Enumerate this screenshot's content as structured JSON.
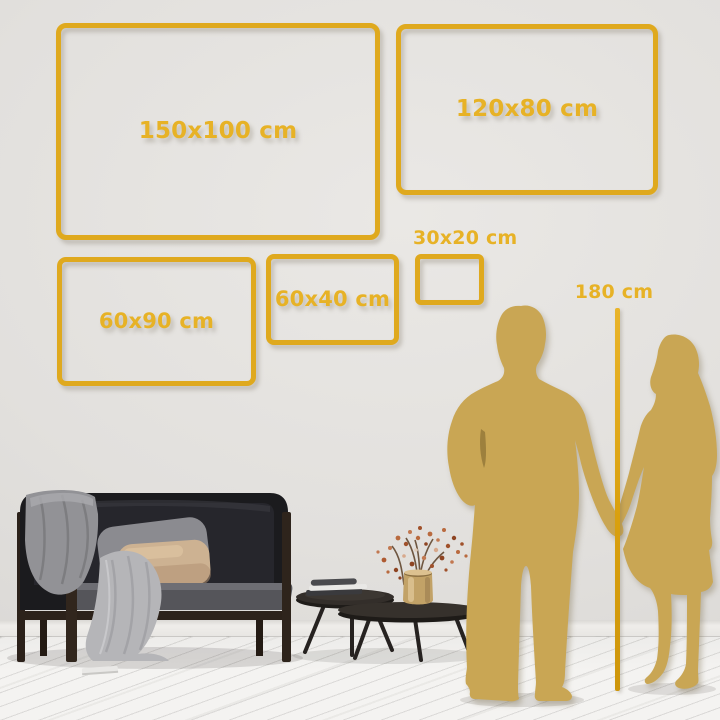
{
  "size_frames": [
    {
      "id": "150x100",
      "label": "150x100 cm"
    },
    {
      "id": "120x80",
      "label": "120x80 cm"
    },
    {
      "id": "60x90",
      "label": "60x90 cm"
    },
    {
      "id": "60x40",
      "label": "60x40 cm"
    },
    {
      "id": "30x20",
      "label": "30x20 cm"
    }
  ],
  "height_marker": {
    "label": "180 cm"
  },
  "colors": {
    "frame_gold": "#DFA91E",
    "label_gold": "#E7B226",
    "marker_line_gold": "#D9A00E",
    "silhouette_gold": "#C9A654",
    "wall": "#E3E1DE",
    "floor": "#F4F3F1"
  },
  "illustrations": {
    "couple": "couple-silhouette-icon",
    "sofa": "sofa-illustration",
    "tables": "coffee-tables-illustration",
    "plant": "vase-plant-illustration"
  }
}
